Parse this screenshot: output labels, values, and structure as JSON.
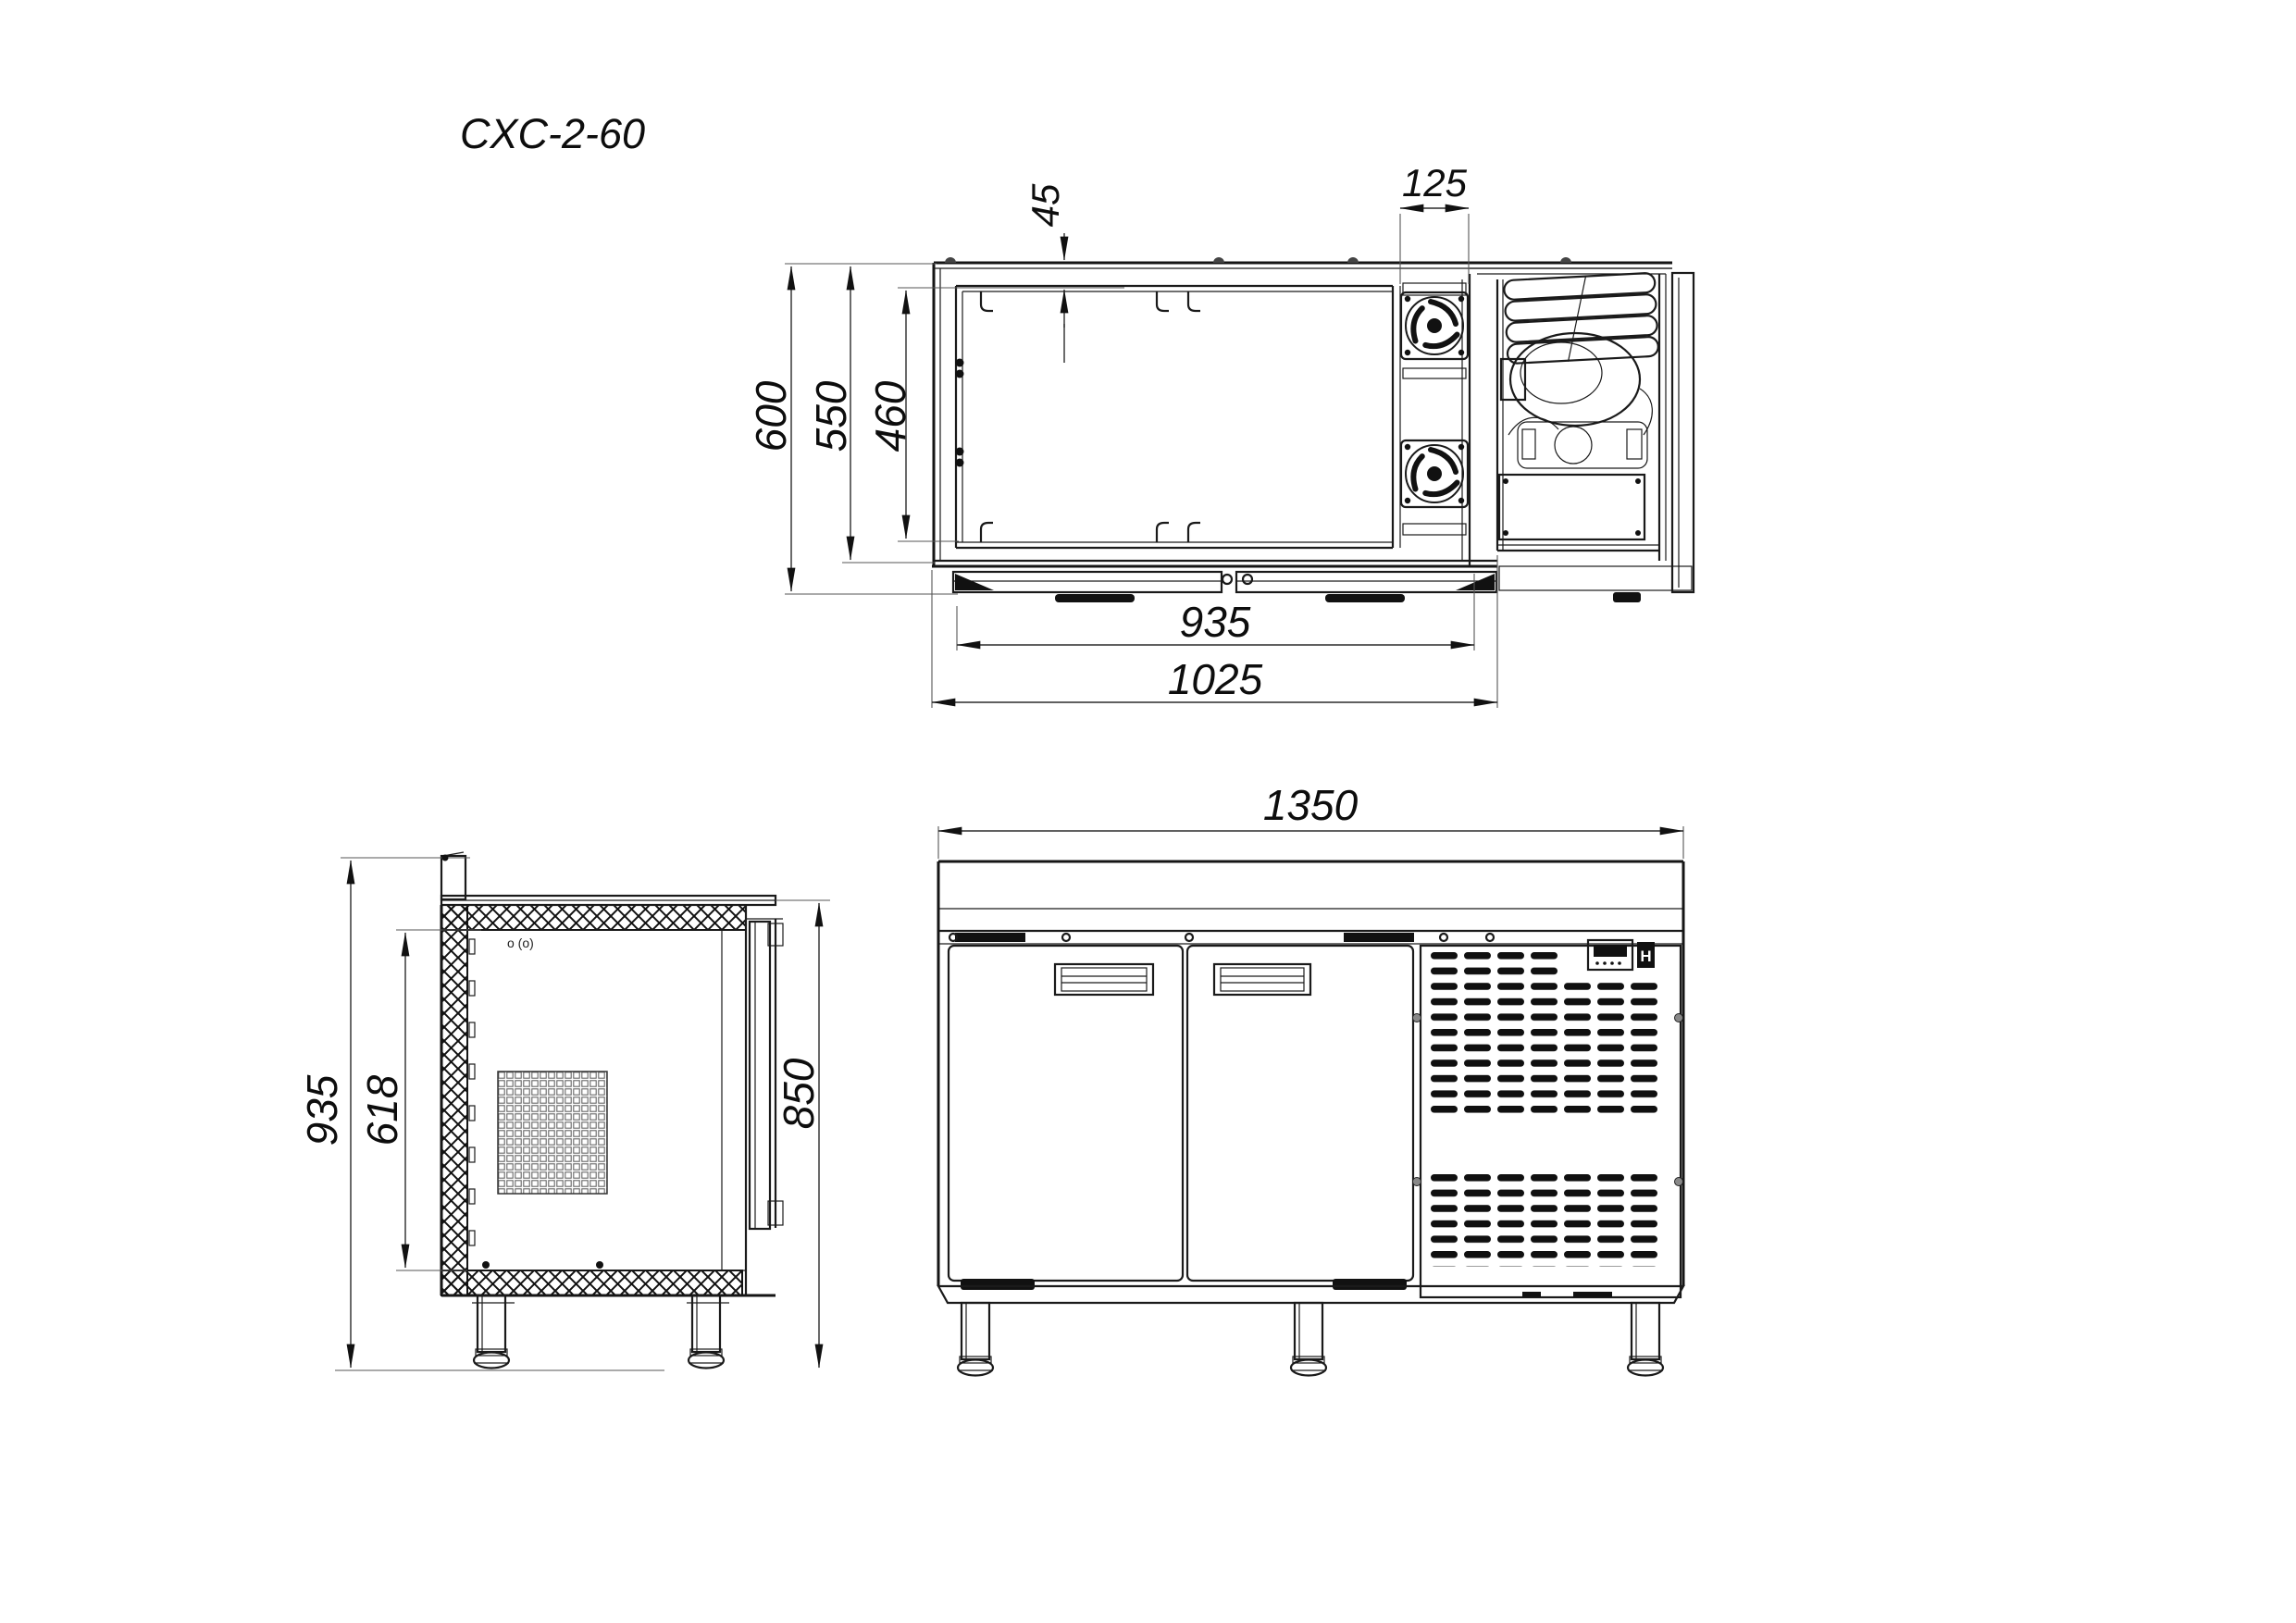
{
  "drawing": {
    "title": "CXC-2-60",
    "background": "#ffffff",
    "line_color": "#1a1a1a"
  },
  "views": {
    "top": {
      "name": "top-section-view"
    },
    "side": {
      "name": "side-section-view"
    },
    "front": {
      "name": "front-view"
    }
  },
  "dimensions": {
    "top": {
      "overall_depth": "600",
      "body_depth": "550",
      "interior_depth": "460",
      "wall_thickness": "45",
      "fan_bay_width": "125",
      "door_front_width": "935",
      "refrigerated_section_width": "1025"
    },
    "side": {
      "overall_height": "935",
      "interior_height": "618",
      "worktop_height": "850"
    },
    "front": {
      "overall_width": "1350"
    }
  },
  "annotations": {
    "sensor_symbol": "o (o)",
    "controller_letter": "H"
  }
}
